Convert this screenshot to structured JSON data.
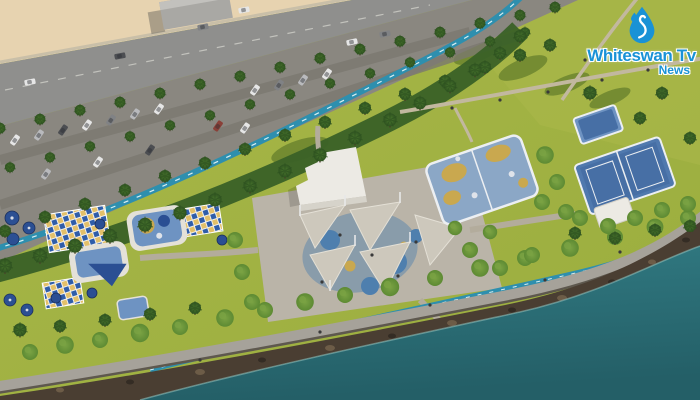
{
  "watermark": {
    "title": "Whiteswan Tv",
    "subtitle": "News",
    "icon": "water-drop-swan-icon"
  },
  "scene": {
    "description": "Aerial rendering of a coastal waterfront park: palm-lined road and parking, playgrounds, shaded plaza with white pavilion, blue sports courts, rocky shoreline and turquoise sea"
  },
  "colors": {
    "sand": "#e7d3b0",
    "road": "#8f8f8d",
    "road_line": "#cfcfc9",
    "sidewalk": "#c9bfa8",
    "asphalt": "#8a8780",
    "asphalt_dark": "#7b786f",
    "lawn": "#9aad3e",
    "lawn_light": "#a8b748",
    "lawn_shadow": "#46651f",
    "tree_band": "#3a6127",
    "palm": "#4c7a2e",
    "palm_dark": "#2e5220",
    "tree": "#5d8a33",
    "tree_light": "#7ba344",
    "trunk": "#4a3c28",
    "bike_lane": "#2e8fae",
    "bike_dash": "#d8eef2",
    "plaza": "#bab4a8",
    "walk": "#b3ac9c",
    "path_tan": "#c2b89f",
    "sail": "#cdc8bc",
    "sail_edge": "#e4e0d6",
    "pavilion": "#eceae4",
    "pavilion_shade": "#d6d3ca",
    "checker_blue": "#2f5da9",
    "checker_yellow": "#e3c06a",
    "canopy_navy": "#2b4f93",
    "pad_white": "#e4e1d8",
    "pad_blue": "#6e93c2",
    "splash_blue": "#4e7fae",
    "court_blue": "#8ba7c6",
    "court_line": "#eceff2",
    "tennis_blue": "#5079ae",
    "tennis_inner": "#476fa5",
    "sand_patch": "#c9a84f",
    "promenade": "#a6a29a",
    "promenade_edge": "#5e584e",
    "rock": "#4a3e32",
    "rock_light": "#6d5c47",
    "rock_dark": "#342c24",
    "water": "#327c84",
    "water_deep": "#245f67",
    "foam": "#8fc0bf",
    "building": "#a9a8a4",
    "car_white": "#e6e6e6",
    "car_silver": "#b9babd",
    "car_gray": "#808285",
    "car_dark": "#4c4e52",
    "car_red": "#8a4038",
    "person": "#3a3a3a",
    "logo_blue": "#1992d6"
  }
}
